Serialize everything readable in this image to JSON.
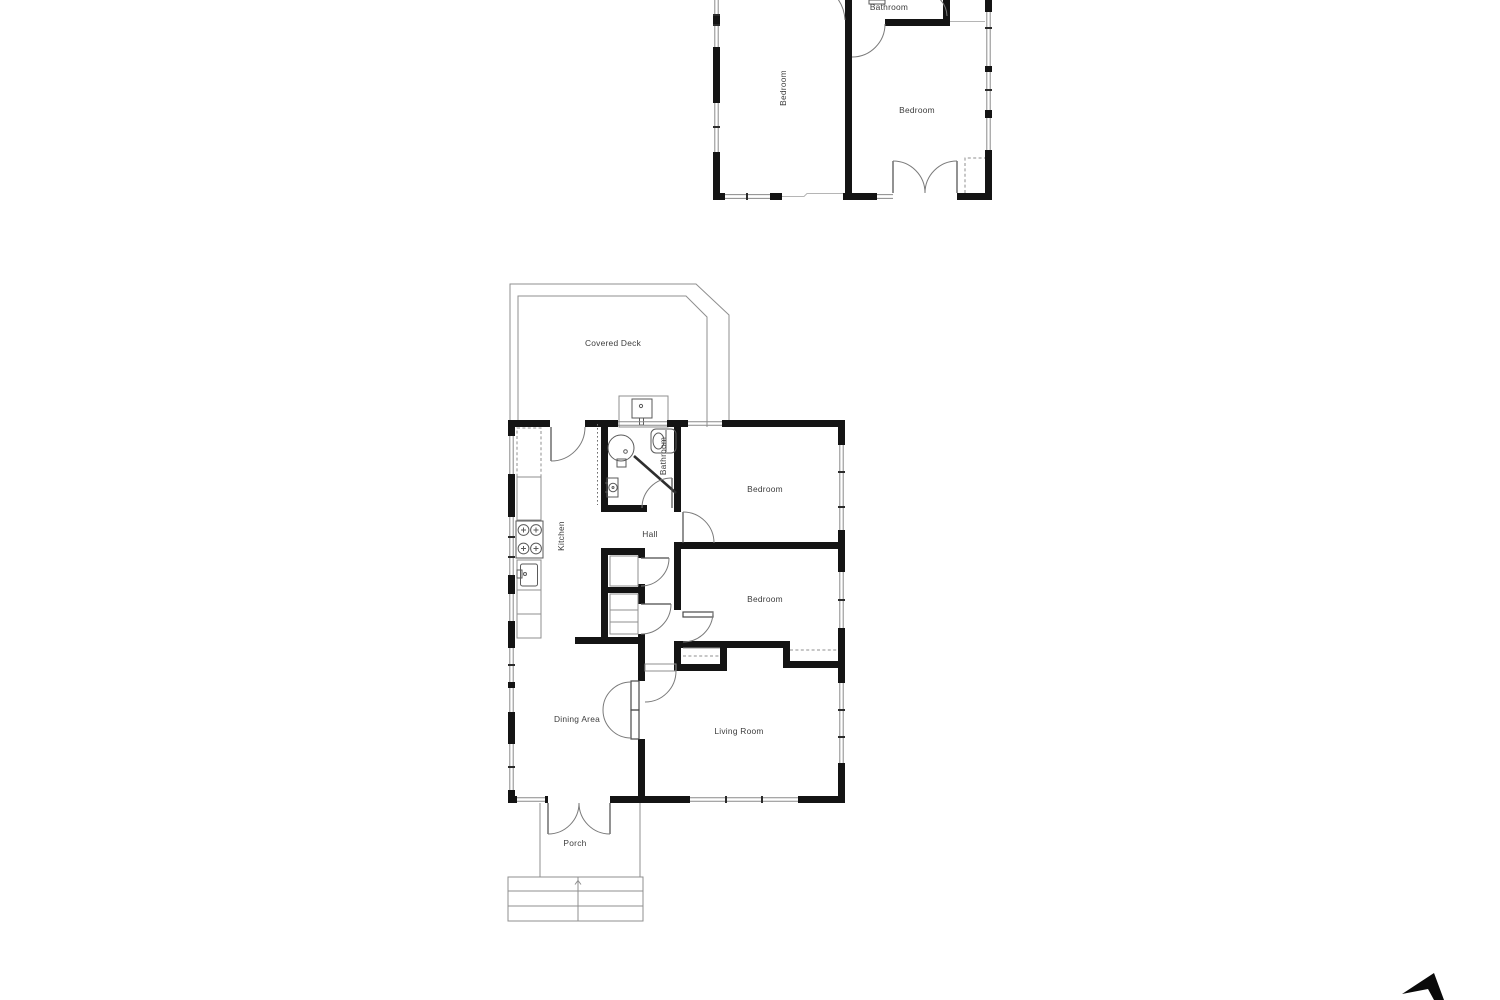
{
  "document": {
    "type": "floor-plan",
    "background": "#ffffff"
  },
  "colors": {
    "wall": "#141414",
    "window_line": "#8a8a8a",
    "fixture_line": "#5a5a5a",
    "label_text": "#3c3c3c",
    "north_arrow": "#0a0a0a"
  },
  "upper_plan": {
    "labels": {
      "bathroom": "Bathroom",
      "bedroom_left": "Bedroom",
      "bedroom_right": "Bedroom"
    }
  },
  "main_plan": {
    "labels": {
      "covered_deck": "Covered Deck",
      "kitchen": "Kitchen",
      "bathroom": "Bathroom",
      "hall": "Hall",
      "bedroom_top": "Bedroom",
      "bedroom_middle": "Bedroom",
      "dining_area": "Dining Area",
      "living_room": "Living Room",
      "porch": "Porch"
    }
  }
}
